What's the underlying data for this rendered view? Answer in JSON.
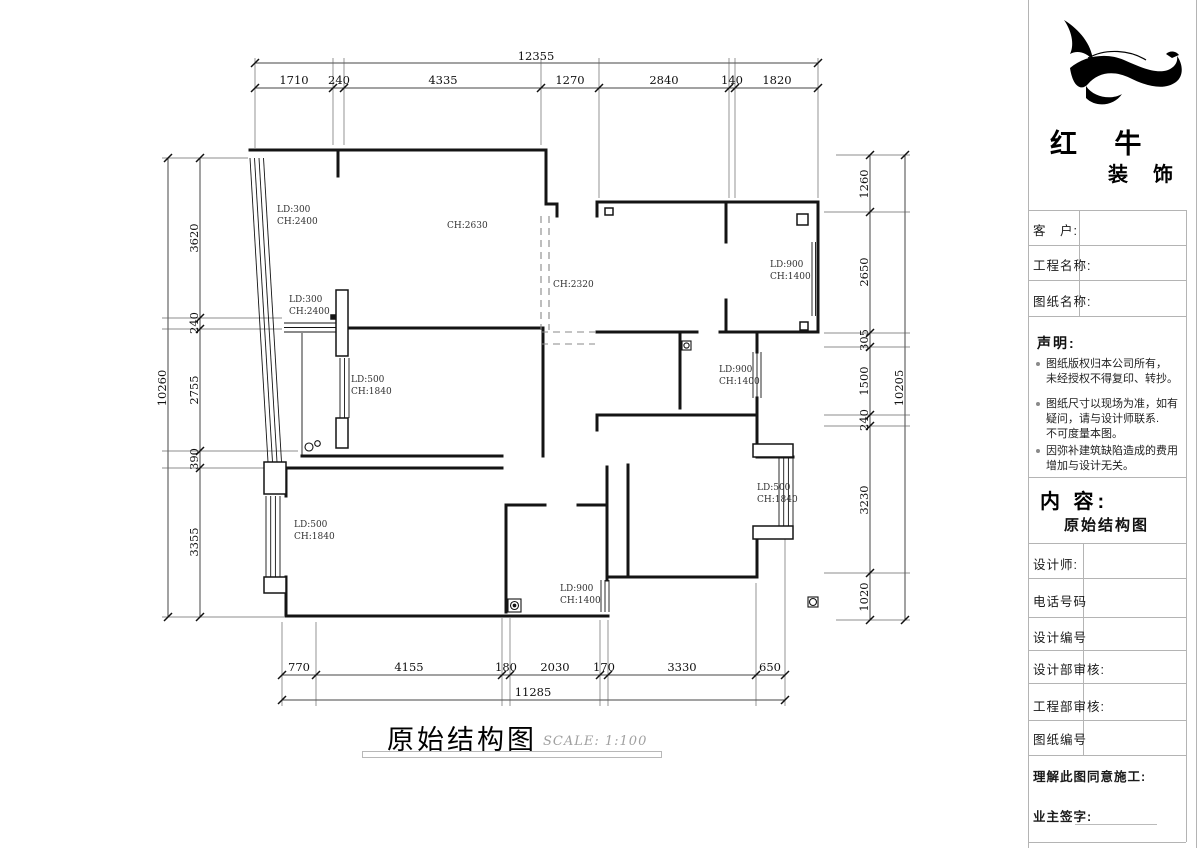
{
  "plan": {
    "title": "原始结构图",
    "scale": "SCALE: 1:100",
    "dims": {
      "top_total": "12355",
      "top": [
        "1710",
        "240",
        "4335",
        "1270",
        "2840",
        "140",
        "1820"
      ],
      "bottom_total": "11285",
      "bottom": [
        "770",
        "4155",
        "180",
        "2030",
        "170",
        "3330",
        "650"
      ],
      "left_total": "10260",
      "left": [
        "3620",
        "240",
        "2755",
        "390",
        "3355"
      ],
      "right_total": "10205",
      "right": [
        "1260",
        "2650",
        "305",
        "1500",
        "240",
        "3230",
        "1020"
      ]
    },
    "annotations": [
      {
        "l1": "LD:300",
        "l2": "CH:2400"
      },
      {
        "l1": "CH:2630",
        "l2": ""
      },
      {
        "l1": "LD:300",
        "l2": "CH:2400"
      },
      {
        "l1": "CH:2320",
        "l2": ""
      },
      {
        "l1": "LD:900",
        "l2": "CH:1400"
      },
      {
        "l1": "LD:500",
        "l2": "CH:1840"
      },
      {
        "l1": "LD:900",
        "l2": "CH:1400"
      },
      {
        "l1": "LD:500",
        "l2": "CH:1840"
      },
      {
        "l1": "LD:500",
        "l2": "CH:1840"
      },
      {
        "l1": "LD:900",
        "l2": "CH:1400"
      }
    ]
  },
  "titleblock": {
    "brand_line1": "红 牛",
    "brand_line2": "装 饰",
    "fields": [
      {
        "label": "客　户:"
      },
      {
        "label": "工程名称:"
      },
      {
        "label": "图纸名称:"
      }
    ],
    "statement_heading": "声明:",
    "statement": [
      {
        "l1": "图纸版权归本公司所有，",
        "l2": "未经授权不得复印、转抄。",
        "l3": ""
      },
      {
        "l1": "图纸尺寸以现场为准，如有",
        "l2": "疑问，请与设计师联系.",
        "l3": "不可度量本图。"
      },
      {
        "l1": "因弥补建筑缺陷造成的费用",
        "l2": "增加与设计无关。",
        "l3": ""
      }
    ],
    "content_heading": "内 容:",
    "content_value": "原始结构图",
    "sign_fields": [
      {
        "label": "设计师:"
      },
      {
        "label": "电话号码"
      },
      {
        "label": "设计编号"
      },
      {
        "label": "设计部审核:"
      },
      {
        "label": "工程部审核:"
      },
      {
        "label": "图纸编号"
      }
    ],
    "agree_label": "理解此图同意施工:",
    "owner_sign_label": "业主签字:"
  }
}
